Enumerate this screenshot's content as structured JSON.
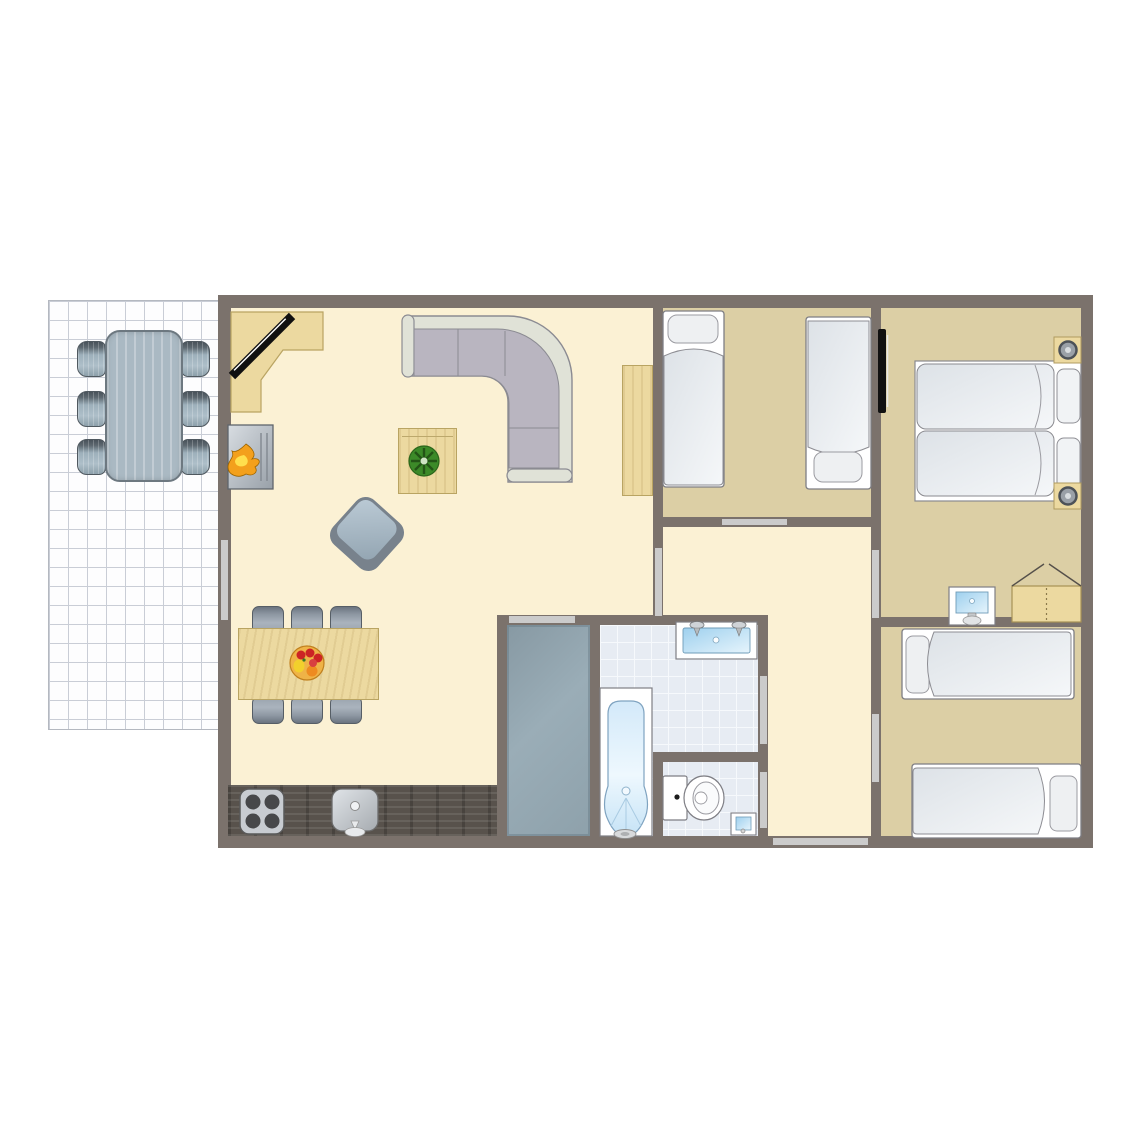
{
  "app": {
    "title": "Holiday home floor plan",
    "view": "2D top-down floorplan"
  },
  "colors": {
    "wall": "#7b726c",
    "living_floor": "#fbf1d4",
    "bedroom_floor": "#dccfa5",
    "bathroom_tile": "#e7ecf3",
    "storage_floor": "#91a3ad",
    "wood": "#ecd9a0",
    "counter_dark_wood": "#58524c",
    "door_marker": "#cbcbcb",
    "terrace_tile": "#fdfdfe",
    "sofa_rim": "#e0e2d7",
    "sofa_seat": "#b9b5c0",
    "bed_linen": "#e8ecef",
    "water_blue": "#a5d2ee",
    "flame_orange": "#f3a01c",
    "plant_green": "#3c8a28"
  },
  "rooms": [
    {
      "name": "terrace",
      "floor": "white tile grid",
      "furniture": [
        "patio-table",
        "patio-chair x6"
      ]
    },
    {
      "name": "living-room",
      "floor": "cream",
      "furniture": [
        "corner-desk",
        "tv",
        "fireplace",
        "corner-sofa",
        "coffee-table",
        "potted-plant",
        "armchair",
        "dining-table",
        "dining-chair x6",
        "sideboard",
        "kitchen-counter",
        "stove",
        "kitchen-sink"
      ]
    },
    {
      "name": "bedroom-top-middle",
      "floor": "tan",
      "furniture": [
        "single-bed x2"
      ]
    },
    {
      "name": "bedroom-top-right",
      "floor": "tan",
      "furniture": [
        "double-bed",
        "nightstand-with-lamp x2",
        "wall-tv",
        "washbasin",
        "wardrobe"
      ]
    },
    {
      "name": "bedroom-bottom-right",
      "floor": "tan",
      "furniture": [
        "single-bed x2"
      ]
    },
    {
      "name": "bathroom",
      "floor": "light-blue tile",
      "furniture": [
        "bathtub-with-shower",
        "double-washbasin"
      ]
    },
    {
      "name": "toilet-room",
      "floor": "light-blue tile",
      "furniture": [
        "toilet",
        "corner-washbasin"
      ]
    },
    {
      "name": "storage-room",
      "floor": "gray",
      "furniture": []
    },
    {
      "name": "hallway",
      "floor": "cream",
      "furniture": []
    }
  ],
  "doors": [
    {
      "name": "terrace-door",
      "between": [
        "living-room",
        "terrace"
      ]
    },
    {
      "name": "hallway-door",
      "between": [
        "living-room",
        "hallway"
      ]
    },
    {
      "name": "bedroom-top-middle-door",
      "between": [
        "hallway",
        "bedroom-top-middle"
      ]
    },
    {
      "name": "bedroom-top-right-door",
      "between": [
        "hallway",
        "bedroom-top-right"
      ]
    },
    {
      "name": "bedroom-bottom-right-door",
      "between": [
        "hallway",
        "bedroom-bottom-right"
      ]
    },
    {
      "name": "bathroom-door",
      "between": [
        "hallway",
        "bathroom"
      ]
    },
    {
      "name": "toilet-door",
      "between": [
        "hallway",
        "toilet-room"
      ]
    },
    {
      "name": "storage-door",
      "between": [
        "living-room",
        "storage-room"
      ]
    },
    {
      "name": "entrance-door",
      "between": [
        "outside",
        "hallway"
      ]
    }
  ]
}
